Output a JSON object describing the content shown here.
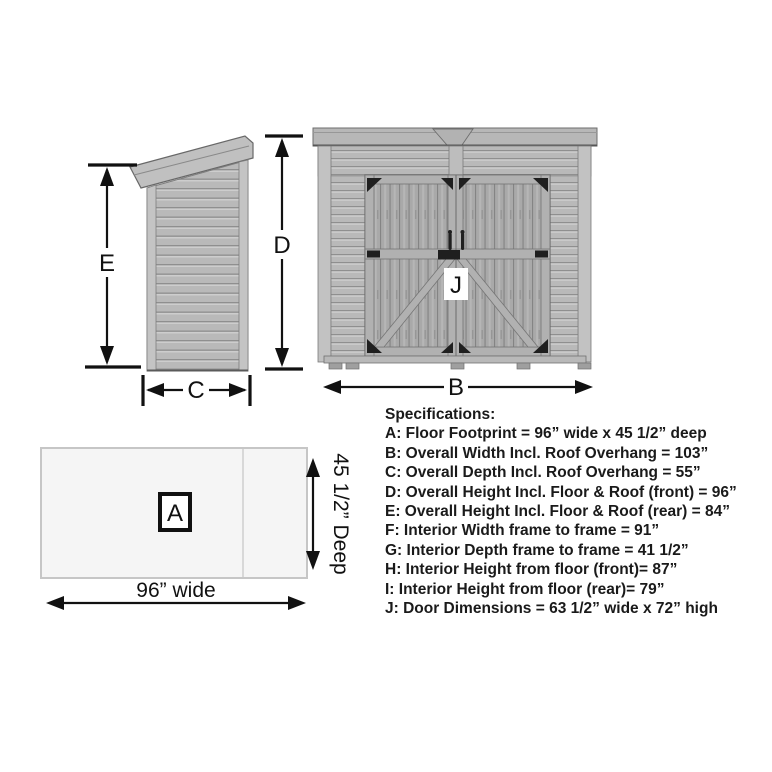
{
  "side_view": {
    "rear_height_label": "E",
    "front_height_label": "D",
    "depth_label": "C"
  },
  "front_view": {
    "width_label": "B",
    "door_label": "J"
  },
  "floor_plan": {
    "area_label": "A",
    "width_text": "96” wide",
    "depth_text": "45 1/2” Deep"
  },
  "specs": {
    "heading": "Specifications:",
    "lines": [
      "A: Floor Footprint = 96” wide x 45 1/2” deep",
      "B: Overall Width Incl. Roof Overhang = 103”",
      "C: Overall Depth Incl. Roof Overhang = 55”",
      "D: Overall Height Incl. Floor & Roof (front) = 96”",
      "E: Overall Height Incl. Floor & Roof (rear) = 84”",
      "F: Interior Width frame to frame = 91”",
      "G: Interior Depth frame to frame = 41 1/2”",
      "H: Interior Height from floor (front)= 87”",
      "I: Interior Height from floor (rear)= 79”",
      "J: Door Dimensions = 63 1/2” wide x 72” high"
    ]
  },
  "colors": {
    "siding": "#b9b9b9",
    "siding_shadow": "#8f8f8f",
    "trim": "#c4c4c4",
    "door_planks": "#a9a9a9",
    "hardware_black": "#1f1f1f",
    "dimension_ink": "#111111",
    "floor_fill": "#f5f5f5",
    "floor_border": "#c6c6c6",
    "spec_text": "#1a1a1a"
  }
}
